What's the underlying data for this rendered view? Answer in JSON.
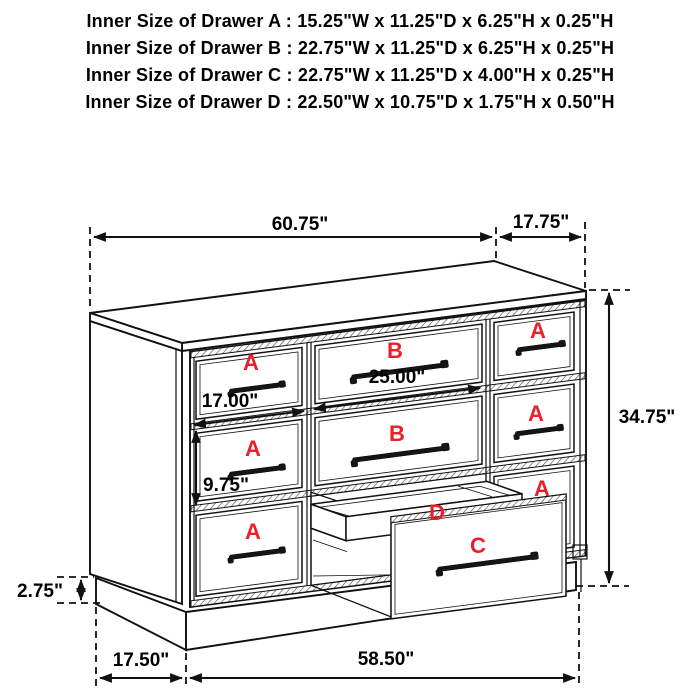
{
  "header": {
    "lines": [
      "Inner Size of Drawer A : 15.25\"W x 11.25\"D x 6.25\"H x 0.25\"H",
      "Inner Size of Drawer B : 22.75\"W x 11.25\"D x 6.25\"H x 0.25\"H",
      "Inner Size of Drawer C : 22.75\"W x 11.25\"D x 4.00\"H x 0.25\"H",
      "Inner Size of Drawer D : 22.50\"W x 10.75\"D x 1.75\"H x 0.50\"H"
    ]
  },
  "diagram": {
    "dimensions": {
      "top_width": "60.75\"",
      "top_depth": "17.75\"",
      "overall_height": "34.75\"",
      "drawer_a_front_width": "17.00\"",
      "drawer_b_front_width": "25.00\"",
      "drawer_a_front_height": "9.75\"",
      "base_height": "2.75\"",
      "base_depth": "17.50\"",
      "base_width": "58.50\""
    },
    "drawer_labels": {
      "a": "A",
      "b": "B",
      "c": "C",
      "d": "D"
    },
    "colors": {
      "label_red": "#e8202a",
      "line_black": "#111111"
    }
  }
}
